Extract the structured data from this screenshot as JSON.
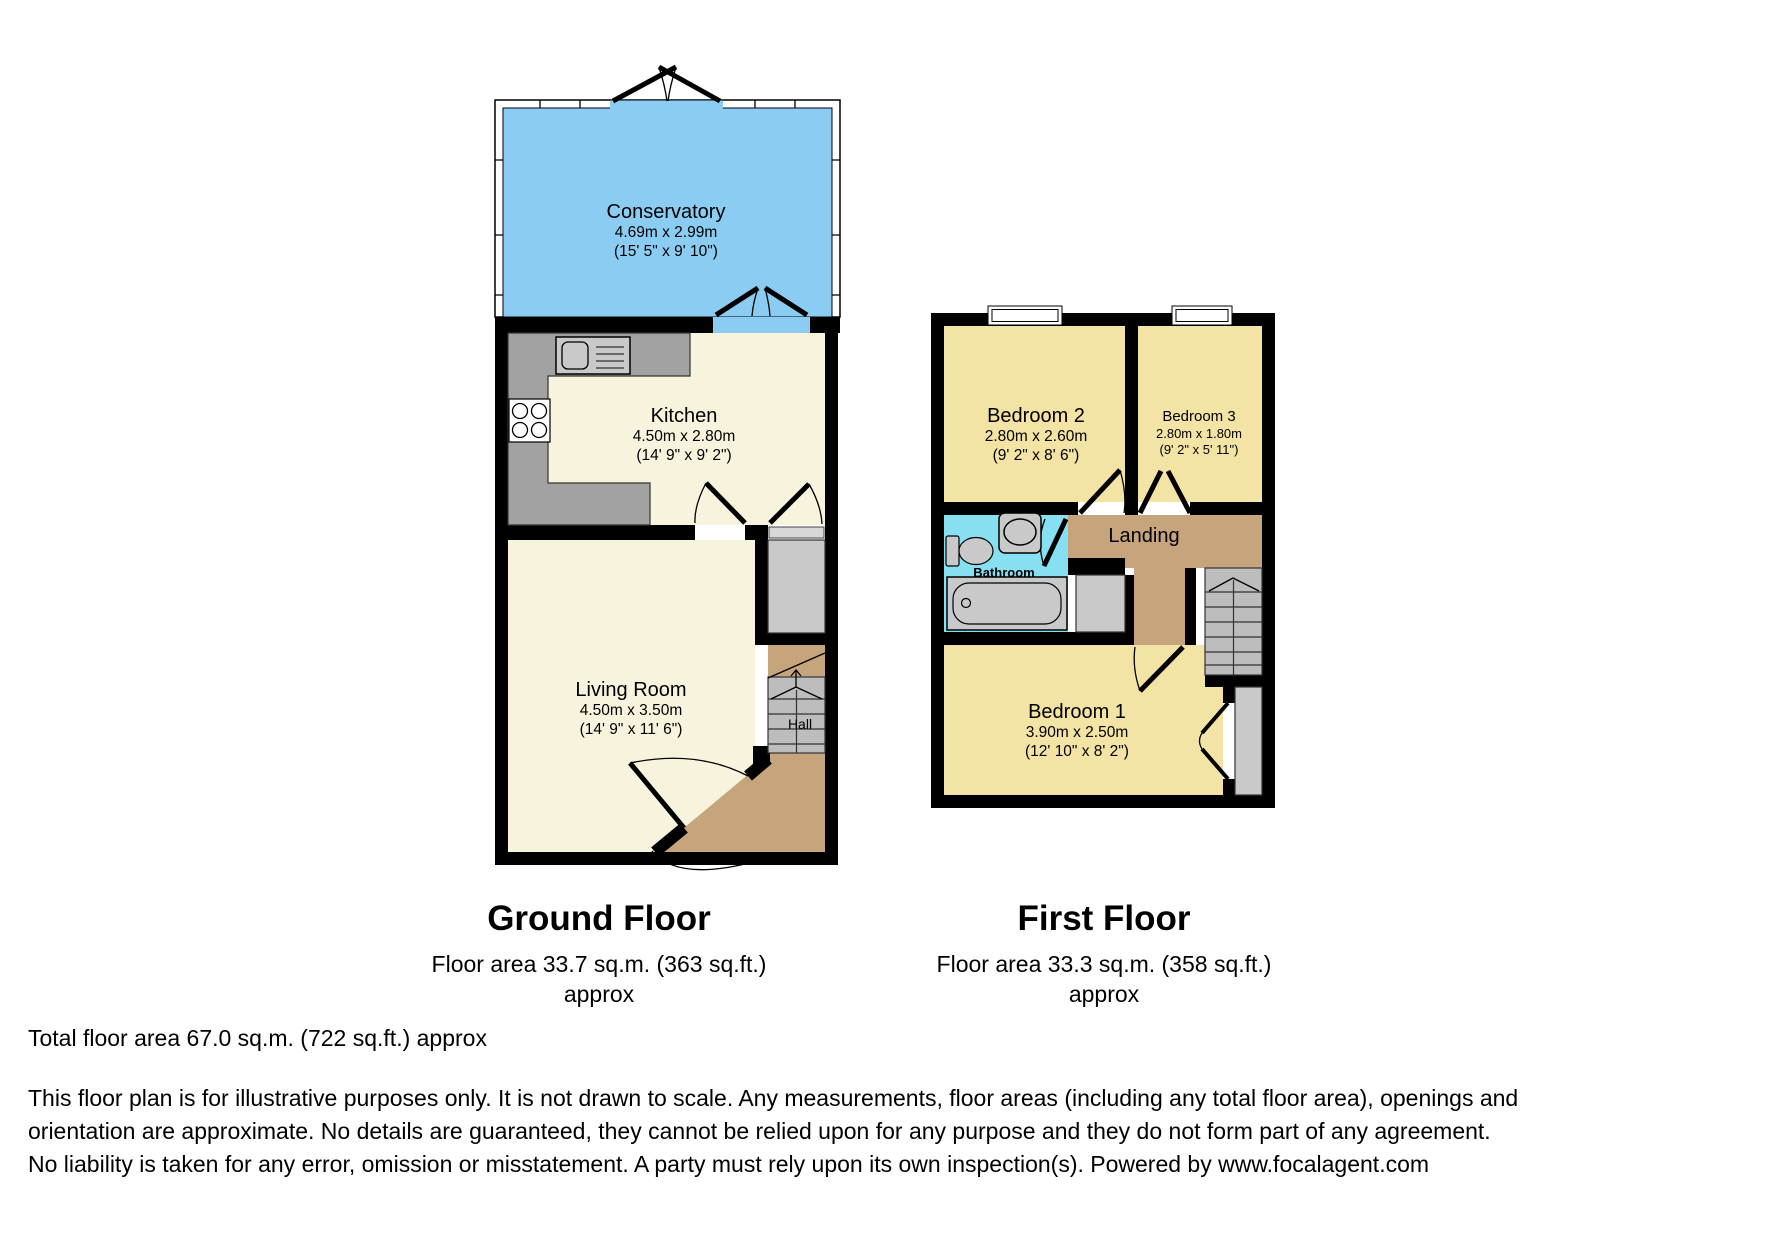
{
  "palette": {
    "wall": "#000000",
    "conservatory": "#8BCDF2",
    "cream": "#F7F3DC",
    "bedroom": "#F3E3A5",
    "bathroom": "#87DFF2",
    "tan": "#C6A47C",
    "stair": "#BDBDBD",
    "cupboard": "#C9C9C9",
    "counter": "#A2A2A2",
    "fixture": "#C9C9C9",
    "door_panel": "#D8D8D8"
  },
  "ground_floor": {
    "title": "Ground Floor",
    "area": "Floor area 33.7 sq.m. (363 sq.ft.)",
    "approx": "approx",
    "rooms": {
      "conservatory": {
        "name": "Conservatory",
        "dim_m": "4.69m x 2.99m",
        "dim_ft": "(15' 5\" x 9' 10\")"
      },
      "kitchen": {
        "name": "Kitchen",
        "dim_m": "4.50m x 2.80m",
        "dim_ft": "(14' 9\" x 9' 2\")"
      },
      "living_room": {
        "name": "Living Room",
        "dim_m": "4.50m x 3.50m",
        "dim_ft": "(14' 9\" x 11' 6\")"
      },
      "hall": {
        "name": "Hall"
      }
    }
  },
  "first_floor": {
    "title": "First Floor",
    "area": "Floor area 33.3 sq.m. (358 sq.ft.)",
    "approx": "approx",
    "rooms": {
      "bedroom2": {
        "name": "Bedroom 2",
        "dim_m": "2.80m x 2.60m",
        "dim_ft": "(9' 2\" x 8' 6\")"
      },
      "bedroom3": {
        "name": "Bedroom 3",
        "dim_m": "2.80m x 1.80m",
        "dim_ft": "(9' 2\" x 5' 11\")"
      },
      "bathroom": {
        "name": "Bathroom"
      },
      "landing": {
        "name": "Landing"
      },
      "bedroom1": {
        "name": "Bedroom 1",
        "dim_m": "3.90m x 2.50m",
        "dim_ft": "(12' 10\" x 8' 2\")"
      }
    }
  },
  "summary": {
    "total_area": "Total floor area 67.0 sq.m. (722 sq.ft.) approx"
  },
  "disclaimer": "This floor plan is for illustrative purposes only. It is not drawn to scale. Any measurements, floor areas (including any total floor area), openings and orientation are approximate. No details are guaranteed, they cannot be relied upon for any purpose and they do not form part of any agreement. No liability is taken for any error, omission or misstatement. A party must rely upon its own inspection(s). Powered by www.focalagent.com"
}
